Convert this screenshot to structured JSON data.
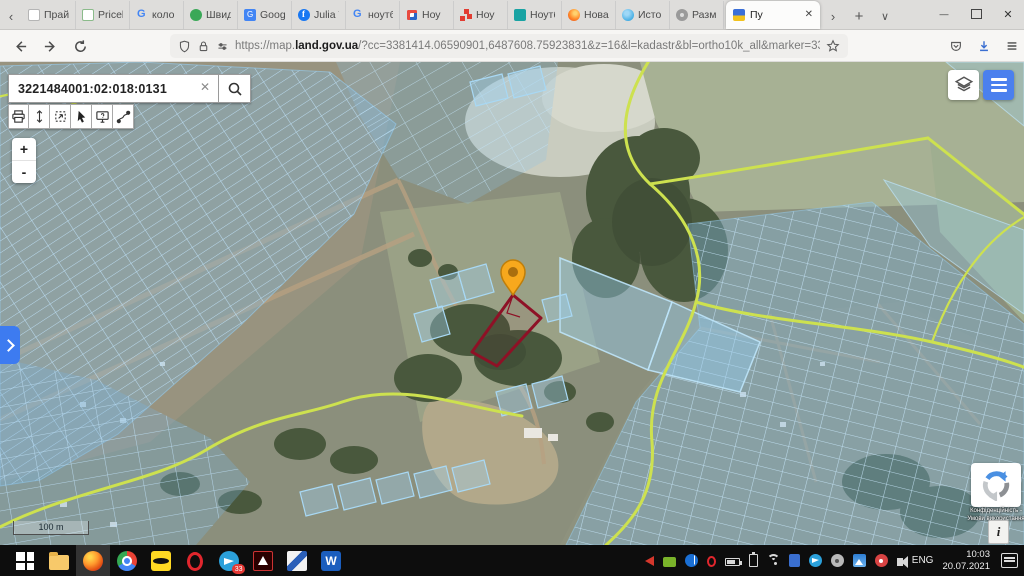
{
  "browser": {
    "tabs": [
      {
        "label": "Прай",
        "icon": "doc"
      },
      {
        "label": "Pricelist_M",
        "icon": "sheet"
      },
      {
        "label": "коло",
        "icon": "google"
      },
      {
        "label": "Швид",
        "icon": "green-badge"
      },
      {
        "label": "Goog",
        "icon": "translate"
      },
      {
        "label": "Julia V",
        "icon": "facebook"
      },
      {
        "label": "ноутб",
        "icon": "google"
      },
      {
        "label": "Ноу",
        "icon": "moyo"
      },
      {
        "label": "Ноу",
        "icon": "red-squares"
      },
      {
        "label": "Ноутб",
        "icon": "teal-badge"
      },
      {
        "label": "Нова",
        "icon": "orange-circle"
      },
      {
        "label": "Исто",
        "icon": "blue-circle"
      },
      {
        "label": "Разм",
        "icon": "gear"
      }
    ],
    "active_tab": {
      "label": "Пу",
      "icon": "ukraine-flag"
    },
    "url": {
      "prefix": "https://map.",
      "domain": "land.gov.ua",
      "path": "/?cc=3381414.06590901,6487608.75923831&z=16&l=kadastr&bl=ortho10k_all&marker=3381414.6"
    }
  },
  "map_ui": {
    "search_value": "3221484001:02:018:0131",
    "zoom_in_label": "+",
    "zoom_out_label": "-",
    "scale_label": "100 m",
    "recaptcha_line1": "Конфіденційність -",
    "recaptcha_line2": "Умови використання",
    "toolbar_icons": [
      "print",
      "measure-distance",
      "measure-area",
      "select",
      "identify",
      "route"
    ]
  },
  "taskbar": {
    "apps": [
      {
        "name": "start"
      },
      {
        "name": "explorer"
      },
      {
        "name": "firefox",
        "active": true
      },
      {
        "name": "chrome"
      },
      {
        "name": "batman"
      },
      {
        "name": "opera"
      },
      {
        "name": "telegram",
        "badge": "33"
      },
      {
        "name": "acrobat"
      },
      {
        "name": "kompas"
      },
      {
        "name": "word"
      }
    ],
    "tray_icons": [
      "media",
      "nvidia",
      "bluetooth",
      "opera-mini",
      "battery",
      "usb",
      "wifi",
      "device",
      "telegram-tray",
      "disc",
      "photos",
      "defender",
      "volume"
    ],
    "language": "ENG",
    "time": "10:03",
    "date": "20.07.2021"
  },
  "colors": {
    "accent_blue": "#4b80ee",
    "parcel_blue": "#9fd4f2",
    "road_yellow": "#cde14f",
    "selected_parcel_red": "#8e1126",
    "marker_orange": "#f7a81d"
  }
}
